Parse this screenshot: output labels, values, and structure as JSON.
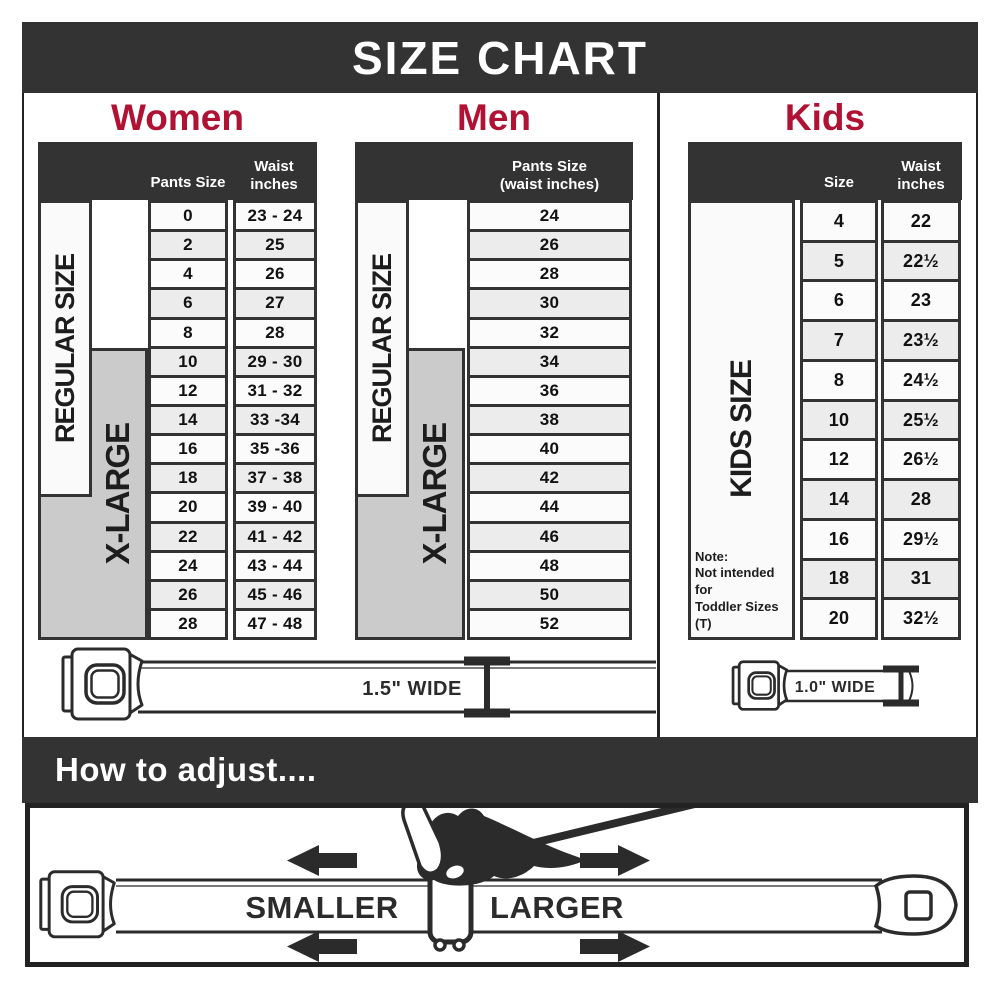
{
  "title_bar": {
    "title": "SIZE CHART"
  },
  "colors": {
    "header_dark": "#333333",
    "accent_red": "#b01234",
    "xlarge_gray": "#cbcbcb",
    "row_alt": "#ececec",
    "line_dark": "#2b2b2b"
  },
  "women": {
    "title": "Women",
    "header": {
      "col1": "Pants Size",
      "col2_line1": "Waist",
      "col2_line2": "inches"
    },
    "regular_label": "REGULAR SIZE",
    "xlarge_label": "X-LARGE",
    "rows": [
      {
        "size": "0",
        "waist": "23 - 24"
      },
      {
        "size": "2",
        "waist": "25"
      },
      {
        "size": "4",
        "waist": "26"
      },
      {
        "size": "6",
        "waist": "27"
      },
      {
        "size": "8",
        "waist": "28"
      },
      {
        "size": "10",
        "waist": "29 - 30"
      },
      {
        "size": "12",
        "waist": "31 - 32"
      },
      {
        "size": "14",
        "waist": "33 -34"
      },
      {
        "size": "16",
        "waist": "35 -36"
      },
      {
        "size": "18",
        "waist": "37 - 38"
      },
      {
        "size": "20",
        "waist": "39 - 40"
      },
      {
        "size": "22",
        "waist": "41 - 42"
      },
      {
        "size": "24",
        "waist": "43 - 44"
      },
      {
        "size": "26",
        "waist": "45 - 46"
      },
      {
        "size": "28",
        "waist": "47 - 48"
      }
    ]
  },
  "men": {
    "title": "Men",
    "header": {
      "line1": "Pants Size",
      "line2": "(waist inches)"
    },
    "regular_label": "REGULAR SIZE",
    "xlarge_label": "X-LARGE",
    "sizes": [
      "24",
      "26",
      "28",
      "30",
      "32",
      "34",
      "36",
      "38",
      "40",
      "42",
      "44",
      "46",
      "48",
      "50",
      "52"
    ]
  },
  "kids": {
    "title": "Kids",
    "header": {
      "col1": "Size",
      "col2_line1": "Waist",
      "col2_line2": "inches"
    },
    "label": "KIDS SIZE",
    "note": [
      "Note:",
      "Not intended for",
      "Toddler Sizes (T)"
    ],
    "rows": [
      {
        "size": "4",
        "waist": "22"
      },
      {
        "size": "5",
        "waist": "22½"
      },
      {
        "size": "6",
        "waist": "23"
      },
      {
        "size": "7",
        "waist": "23½"
      },
      {
        "size": "8",
        "waist": "24½"
      },
      {
        "size": "10",
        "waist": "25½"
      },
      {
        "size": "12",
        "waist": "26½"
      },
      {
        "size": "14",
        "waist": "28"
      },
      {
        "size": "16",
        "waist": "29½"
      },
      {
        "size": "18",
        "waist": "31"
      },
      {
        "size": "20",
        "waist": "32½"
      }
    ]
  },
  "belts": {
    "adult_label": "1.5\" WIDE",
    "kids_label": "1.0\" WIDE"
  },
  "adjust": {
    "title": "How to adjust....",
    "smaller": "SMALLER",
    "larger": "LARGER"
  }
}
